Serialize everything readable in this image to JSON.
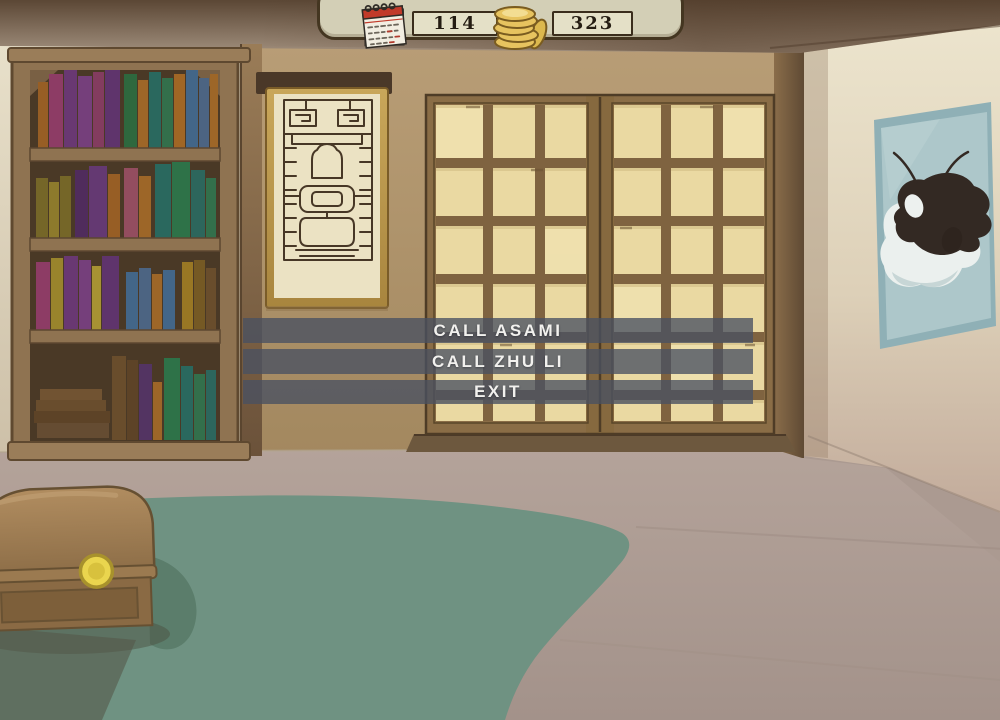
{
  "hud": {
    "day_counter": {
      "icon": "calendar-icon",
      "value": "114"
    },
    "money_counter": {
      "icon": "coins-icon",
      "value": "323"
    }
  },
  "menu": {
    "items": [
      {
        "id": "call-asami",
        "label": "CALL ASAMI"
      },
      {
        "id": "call-zhu-li",
        "label": "CALL ZHU LI"
      },
      {
        "id": "exit",
        "label": "EXIT"
      }
    ]
  },
  "scene": {
    "objects": [
      "bookshelf",
      "wall-scroll",
      "shoji-doors",
      "koi-painting",
      "treasure-chest",
      "rug"
    ]
  },
  "colors": {
    "menu_bar": "#495161",
    "menu_text": "#f2f1ee",
    "hud_panel": "#d3cfb6",
    "hud_border": "#443621",
    "counter_box": "#e4e0c7",
    "counter_text": "#241c12",
    "coin_gold": "#e7c35f",
    "calendar_red": "#c13a2a",
    "rug_green": "#6f9282",
    "painting_blue": "#adc7ca"
  }
}
